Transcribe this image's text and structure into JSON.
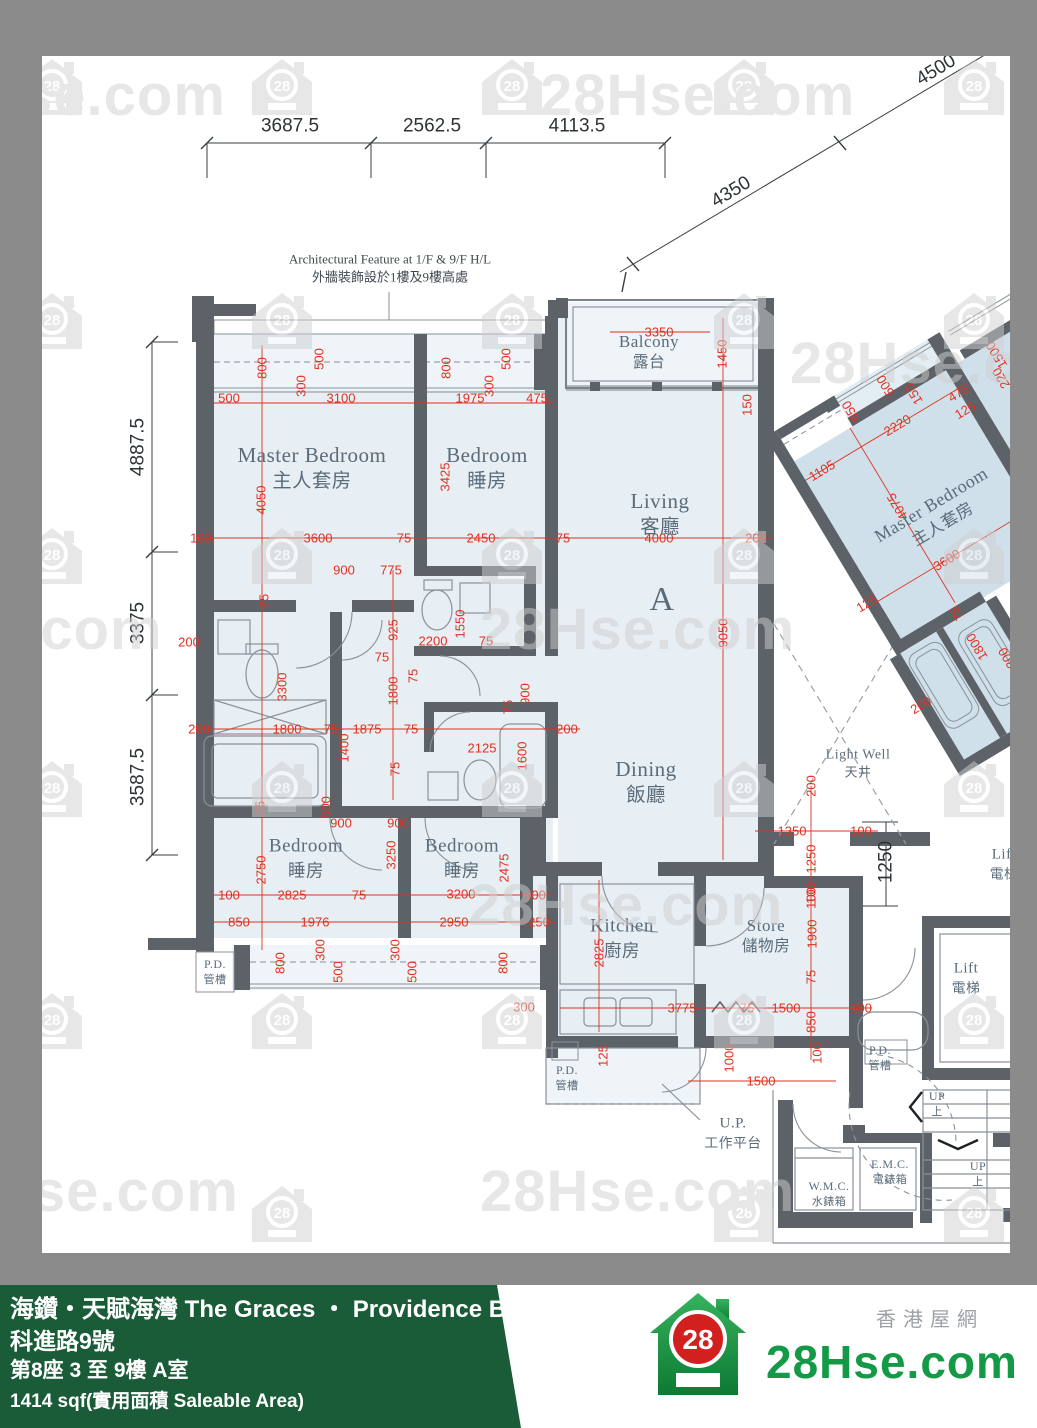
{
  "colors": {
    "red": "#e0321f",
    "wall": "#5d6269",
    "fill": "#e7eef4",
    "fill_alt": "#cfe0ea",
    "frame": "#8b8b8b",
    "footer_green": "#1a5c38",
    "logo_green": "#149a47",
    "logo_red": "#d2201f",
    "label": "#5a6b79"
  },
  "watermark": {
    "text": "28Hse.com",
    "badge": "28",
    "icons": [
      [
        20,
        58
      ],
      [
        250,
        58
      ],
      [
        480,
        58
      ],
      [
        712,
        58
      ],
      [
        942,
        58
      ],
      [
        20,
        292
      ],
      [
        250,
        292
      ],
      [
        480,
        292
      ],
      [
        712,
        292
      ],
      [
        942,
        292
      ],
      [
        20,
        527
      ],
      [
        250,
        527
      ],
      [
        480,
        527
      ],
      [
        712,
        527
      ],
      [
        942,
        527
      ],
      [
        20,
        760
      ],
      [
        250,
        760
      ],
      [
        480,
        760
      ],
      [
        712,
        760
      ],
      [
        942,
        760
      ],
      [
        20,
        992
      ],
      [
        250,
        992
      ],
      [
        480,
        992
      ],
      [
        712,
        992
      ],
      [
        942,
        992
      ],
      [
        250,
        1185
      ],
      [
        712,
        1185
      ],
      [
        942,
        1185
      ]
    ],
    "texts": [
      {
        "t": "se.com",
        "x": 20,
        "y": 62
      },
      {
        "t": "28Hse.com",
        "x": 540,
        "y": 62
      },
      {
        "t": "28Hse.com",
        "x": 790,
        "y": 330
      },
      {
        "t": "e.com",
        "x": -10,
        "y": 596
      },
      {
        "t": "28Hse.com",
        "x": 480,
        "y": 596
      },
      {
        "t": "28Hse.com",
        "x": 468,
        "y": 872
      },
      {
        "t": "Hse.com",
        "x": -10,
        "y": 1158
      },
      {
        "t": "28Hse.com",
        "x": 480,
        "y": 1158
      }
    ]
  },
  "plan": {
    "annotation": {
      "en": "Architectural Feature at 1/F & 9/F H/L",
      "zh": "外牆裝飾設於1樓及9樓高處",
      "x": 390,
      "y": 268
    },
    "labels": [
      {
        "en": "Master Bedroom",
        "zh": "主人套房",
        "x": 312,
        "y": 468,
        "s": 21
      },
      {
        "en": "Bedroom",
        "zh": "睡房",
        "x": 487,
        "y": 468,
        "s": 21
      },
      {
        "en": "Living",
        "zh": "客廳",
        "x": 660,
        "y": 514,
        "s": 21
      },
      {
        "en": "Balcony",
        "zh": "露台",
        "x": 649,
        "y": 352,
        "s": 17
      },
      {
        "en": "Dining",
        "zh": "飯廳",
        "x": 646,
        "y": 782,
        "s": 21
      },
      {
        "en": "Bedroom",
        "zh": "睡房",
        "x": 306,
        "y": 858,
        "s": 19
      },
      {
        "en": "Bedroom",
        "zh": "睡房",
        "x": 462,
        "y": 858,
        "s": 19
      },
      {
        "en": "Kitchen",
        "zh": "廚房",
        "x": 622,
        "y": 938,
        "s": 19
      },
      {
        "en": "Store",
        "zh": "儲物房",
        "x": 766,
        "y": 936,
        "s": 17
      },
      {
        "en": "Light Well",
        "zh": "天井",
        "x": 858,
        "y": 764,
        "s": 14
      },
      {
        "en": "Lift",
        "zh": "電梯",
        "x": 966,
        "y": 978,
        "s": 15
      },
      {
        "en": "Lift",
        "zh": "電梯",
        "x": 1004,
        "y": 864,
        "s": 15
      },
      {
        "en": "U.P.",
        "zh": "工作平台",
        "x": 733,
        "y": 1133,
        "s": 15
      },
      {
        "en": "P.D.",
        "zh": "管槽",
        "x": 215,
        "y": 972,
        "s": 12
      },
      {
        "en": "P.D.",
        "zh": "管槽",
        "x": 567,
        "y": 1078,
        "s": 12
      },
      {
        "en": "P.D.",
        "zh": "管槽",
        "x": 880,
        "y": 1058,
        "s": 12
      },
      {
        "en": "W.M.C.",
        "zh": "水錶箱",
        "x": 829,
        "y": 1194,
        "s": 12
      },
      {
        "en": "E.M.C.",
        "zh": "電錶箱",
        "x": 890,
        "y": 1172,
        "s": 12
      },
      {
        "en": "UP",
        "zh": "上",
        "x": 937,
        "y": 1104,
        "s": 12
      },
      {
        "en": "UP",
        "zh": "上",
        "x": 978,
        "y": 1174,
        "s": 12
      },
      {
        "en": "A",
        "zh": "",
        "x": 662,
        "y": 600,
        "s": 34
      }
    ],
    "black_dims": [
      [
        "3687.5",
        290,
        126,
        0
      ],
      [
        "2562.5",
        432,
        126,
        0
      ],
      [
        "4113.5",
        577,
        126,
        0
      ],
      [
        "4350",
        731,
        192,
        31
      ],
      [
        "4500",
        936,
        70,
        31
      ],
      [
        "4887.5",
        138,
        447,
        90
      ],
      [
        "3375",
        138,
        623,
        90
      ],
      [
        "3587.5",
        138,
        777,
        90
      ],
      [
        "1250",
        886,
        862,
        90
      ]
    ],
    "red_dims": [
      [
        "500",
        229,
        398
      ],
      [
        "3100",
        341,
        398
      ],
      [
        "1975",
        470,
        398
      ],
      [
        "475",
        537,
        398
      ],
      [
        "800",
        262,
        368,
        90
      ],
      [
        "300",
        301,
        386,
        90
      ],
      [
        "500",
        319,
        359,
        90
      ],
      [
        "800",
        446,
        368,
        90
      ],
      [
        "300",
        489,
        386,
        90
      ],
      [
        "500",
        506,
        359,
        90
      ],
      [
        "100",
        201,
        538
      ],
      [
        "3600",
        318,
        538
      ],
      [
        "75",
        404,
        538
      ],
      [
        "2450",
        481,
        538
      ],
      [
        "75",
        563,
        538
      ],
      [
        "4000",
        659,
        538
      ],
      [
        "200",
        756,
        538
      ],
      [
        "4050",
        261,
        500,
        90
      ],
      [
        "3425",
        445,
        477,
        90
      ],
      [
        "900",
        344,
        570
      ],
      [
        "775",
        391,
        570
      ],
      [
        "75",
        264,
        601,
        90
      ],
      [
        "925",
        393,
        630,
        90
      ],
      [
        "75",
        382,
        657
      ],
      [
        "2200",
        433,
        641
      ],
      [
        "1550",
        460,
        624,
        90
      ],
      [
        "75",
        486,
        641
      ],
      [
        "3300",
        282,
        687,
        90
      ],
      [
        "1800",
        393,
        691,
        90
      ],
      [
        "75",
        413,
        676,
        90
      ],
      [
        "900",
        525,
        694,
        90
      ],
      [
        "75",
        508,
        707,
        90
      ],
      [
        "200",
        199,
        729
      ],
      [
        "1800",
        287,
        729
      ],
      [
        "75",
        331,
        729
      ],
      [
        "1875",
        367,
        729
      ],
      [
        "75",
        411,
        729
      ],
      [
        "200",
        567,
        729
      ],
      [
        "2125",
        482,
        748
      ],
      [
        "1600",
        522,
        756,
        90
      ],
      [
        "1400",
        344,
        748,
        90
      ],
      [
        "75",
        395,
        769,
        90
      ],
      [
        "500",
        326,
        807,
        90
      ],
      [
        "900",
        341,
        823
      ],
      [
        "900",
        398,
        823
      ],
      [
        "75",
        260,
        808,
        90
      ],
      [
        "9050",
        723,
        633,
        90
      ],
      [
        "2750",
        261,
        870,
        90
      ],
      [
        "3250",
        391,
        855,
        90
      ],
      [
        "2475",
        504,
        868,
        90
      ],
      [
        "100",
        229,
        895
      ],
      [
        "2825",
        292,
        895
      ],
      [
        "75",
        359,
        895
      ],
      [
        "3200",
        461,
        894
      ],
      [
        "100",
        535,
        895
      ],
      [
        "850",
        239,
        922
      ],
      [
        "1976",
        315,
        922
      ],
      [
        "2950",
        454,
        922
      ],
      [
        "250",
        539,
        922
      ],
      [
        "800",
        280,
        963,
        90
      ],
      [
        "300",
        320,
        950,
        90
      ],
      [
        "500",
        338,
        972,
        90
      ],
      [
        "300",
        395,
        950,
        90
      ],
      [
        "500",
        412,
        972,
        90
      ],
      [
        "800",
        503,
        963,
        90
      ],
      [
        "300",
        524,
        1007
      ],
      [
        "100",
        811,
        893,
        90
      ],
      [
        "1900",
        812,
        934,
        90
      ],
      [
        "2825",
        599,
        953,
        90
      ],
      [
        "75",
        811,
        977,
        90
      ],
      [
        "3775",
        682,
        1008
      ],
      [
        "75",
        747,
        1008
      ],
      [
        "1500",
        786,
        1008
      ],
      [
        "850",
        811,
        1022,
        90
      ],
      [
        "100",
        861,
        1008
      ],
      [
        "125",
        603,
        1056,
        90
      ],
      [
        "1000",
        729,
        1058,
        90
      ],
      [
        "1500",
        761,
        1081
      ],
      [
        "100",
        817,
        1053,
        90
      ],
      [
        "200",
        811,
        786,
        90
      ],
      [
        "1350",
        792,
        831
      ],
      [
        "100",
        861,
        831
      ],
      [
        "1250",
        811,
        859,
        90
      ],
      [
        "100",
        811,
        898,
        90
      ],
      [
        "3350",
        659,
        332
      ],
      [
        "1450",
        722,
        354,
        90
      ],
      [
        "150",
        747,
        405,
        90
      ],
      [
        "200",
        189,
        642
      ]
    ]
  },
  "rotated_unit": {
    "labels": [
      {
        "en": "Master Bedroom",
        "zh": "主人套房",
        "x": 125,
        "y": 155,
        "s": 18
      }
    ],
    "dims": [
      [
        "650",
        104,
        22,
        90
      ],
      [
        "500",
        147,
        18,
        90
      ],
      [
        "150",
        167,
        40,
        90
      ],
      [
        "2220",
        137,
        58
      ],
      [
        "475",
        206,
        62
      ],
      [
        "125",
        203,
        80
      ],
      [
        "1500",
        258,
        49,
        90
      ],
      [
        "220",
        250,
        71,
        90
      ],
      [
        "1105",
        49,
        58
      ],
      [
        "4075",
        95,
        128,
        90
      ],
      [
        "3600",
        110,
        199
      ],
      [
        "125",
        19,
        195
      ],
      [
        "75",
        91,
        250,
        90
      ],
      [
        "1800",
        91,
        289,
        90
      ],
      [
        "300",
        111,
        314,
        90
      ],
      [
        "200",
        13,
        310
      ]
    ]
  },
  "footer": {
    "line1": "海鑽・天賦海灣 The Graces ・ Providence Bay",
    "line2": "科進路9號",
    "line3": "第8座 3 至 9樓 A室",
    "line4": "1414 sqf(實用面積 Saleable Area)",
    "logo_text": "28Hse.com",
    "logo_badge": "28",
    "logo_tagline": "香港屋網"
  }
}
